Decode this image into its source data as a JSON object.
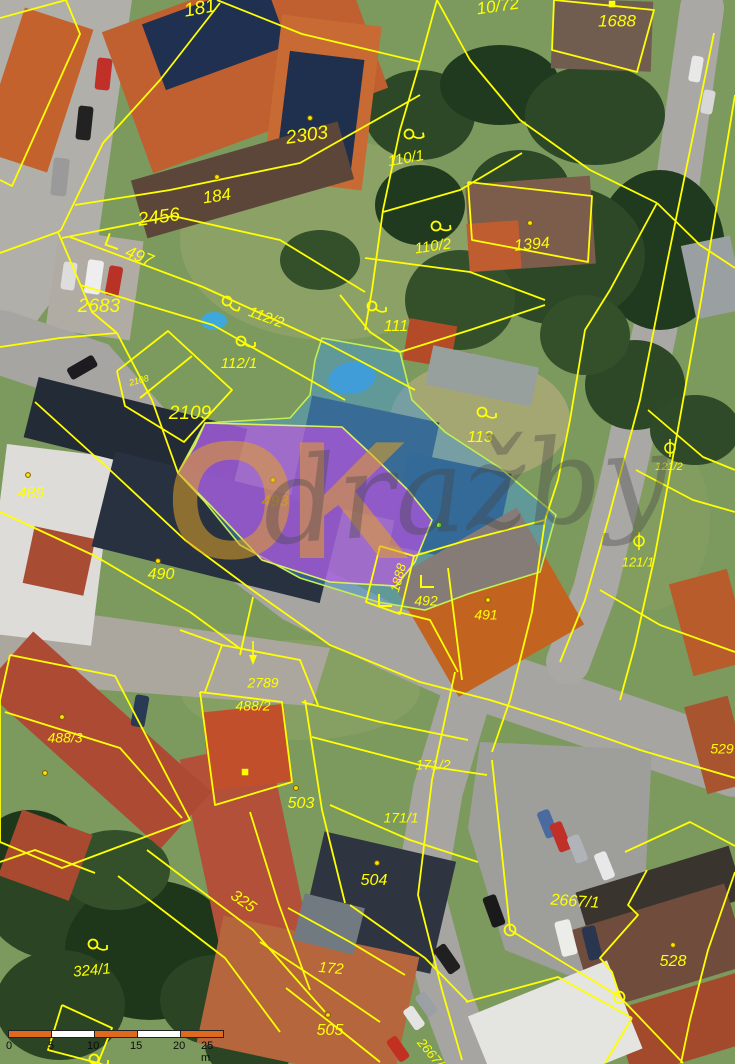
{
  "map": {
    "watermark": {
      "part1": "OK",
      "part2": "dražby"
    },
    "colors": {
      "boundary": "#ffff00",
      "label": "#ffff00",
      "label_muted": "#b8912a",
      "dot_fill": "#ffe400",
      "dot_green": "#86ff4d",
      "scalebar_orange": "#dd6a1e"
    },
    "highlights": {
      "blue": {
        "points": "322,338 400,352 412,400 445,432 500,468 556,515 540,572 468,594 425,610 378,602 300,578 240,545 205,502 178,473 205,423 290,418 310,395 315,360",
        "fill": "rgba(70,150,215,0.48)",
        "stroke": "#c3ef52"
      },
      "purple": {
        "points": "205,423 342,427 372,455 408,490 432,520 415,562 396,586 330,582 262,560 210,505 178,473 195,445",
        "fill": "rgba(198,80,232,0.62)",
        "stroke": "#d9f25a"
      }
    },
    "labels": [
      {
        "t": "181",
        "x": 200,
        "y": 9,
        "r": -10,
        "s": 19
      },
      {
        "t": "10/72",
        "x": 498,
        "y": 7,
        "r": -8,
        "s": 17
      },
      {
        "t": "1688",
        "x": 617,
        "y": 22,
        "r": 0,
        "s": 17
      },
      {
        "t": "2303",
        "x": 307,
        "y": 136,
        "r": -8,
        "s": 19
      },
      {
        "t": "184",
        "x": 217,
        "y": 197,
        "r": -8,
        "s": 17
      },
      {
        "t": "2456",
        "x": 159,
        "y": 218,
        "r": -8,
        "s": 19
      },
      {
        "t": "497",
        "x": 139,
        "y": 257,
        "r": 22,
        "s": 17
      },
      {
        "t": "2683",
        "x": 99,
        "y": 307,
        "r": 0,
        "s": 19
      },
      {
        "t": "110/1",
        "x": 406,
        "y": 159,
        "r": -10,
        "s": 15
      },
      {
        "t": "110/2",
        "x": 433,
        "y": 247,
        "r": -8,
        "s": 15
      },
      {
        "t": "1394",
        "x": 532,
        "y": 245,
        "r": -5,
        "s": 16
      },
      {
        "t": "112/2",
        "x": 266,
        "y": 318,
        "r": 20,
        "s": 15
      },
      {
        "t": "112/1",
        "x": 239,
        "y": 364,
        "r": 0,
        "s": 15
      },
      {
        "t": "111",
        "x": 396,
        "y": 327,
        "r": 0,
        "s": 16
      },
      {
        "t": "2108",
        "x": 139,
        "y": 381,
        "r": -15,
        "s": 9
      },
      {
        "t": "2109",
        "x": 190,
        "y": 414,
        "r": 0,
        "s": 19
      },
      {
        "t": "113",
        "x": 480,
        "y": 438,
        "r": 0,
        "s": 16
      },
      {
        "t": "121/2",
        "x": 669,
        "y": 467,
        "r": 0,
        "s": 11
      },
      {
        "t": "121/1",
        "x": 638,
        "y": 563,
        "r": 0,
        "s": 13
      },
      {
        "t": "489",
        "x": 31,
        "y": 494,
        "r": 0,
        "s": 16
      },
      {
        "t": "490",
        "x": 161,
        "y": 575,
        "r": 0,
        "s": 16
      },
      {
        "t": "493",
        "x": 275,
        "y": 502,
        "r": 0,
        "s": 16,
        "c": "#b8912a"
      },
      {
        "t": "1888",
        "x": 399,
        "y": 578,
        "r": -75,
        "s": 13
      },
      {
        "t": "492",
        "x": 426,
        "y": 602,
        "r": 0,
        "s": 14
      },
      {
        "t": "491",
        "x": 486,
        "y": 616,
        "r": 0,
        "s": 14
      },
      {
        "t": "529",
        "x": 722,
        "y": 750,
        "r": 0,
        "s": 14
      },
      {
        "t": "488/3",
        "x": 65,
        "y": 739,
        "r": 0,
        "s": 14
      },
      {
        "t": "2789",
        "x": 263,
        "y": 684,
        "r": 0,
        "s": 14
      },
      {
        "t": "488/2",
        "x": 253,
        "y": 707,
        "r": 0,
        "s": 14
      },
      {
        "t": "503",
        "x": 301,
        "y": 804,
        "r": 0,
        "s": 16
      },
      {
        "t": "171/2",
        "x": 433,
        "y": 766,
        "r": 0,
        "s": 14
      },
      {
        "t": "171/1",
        "x": 401,
        "y": 819,
        "r": 0,
        "s": 14
      },
      {
        "t": "504",
        "x": 374,
        "y": 881,
        "r": 0,
        "s": 16
      },
      {
        "t": "172",
        "x": 331,
        "y": 969,
        "r": 5,
        "s": 15
      },
      {
        "t": "505",
        "x": 330,
        "y": 1031,
        "r": 0,
        "s": 16
      },
      {
        "t": "325",
        "x": 243,
        "y": 902,
        "r": 35,
        "s": 16
      },
      {
        "t": "324/1",
        "x": 92,
        "y": 971,
        "r": -5,
        "s": 15
      },
      {
        "t": "2667/1",
        "x": 575,
        "y": 902,
        "r": 4,
        "s": 16
      },
      {
        "t": "528",
        "x": 673,
        "y": 962,
        "r": 0,
        "s": 16
      },
      {
        "t": "2667/2",
        "x": 432,
        "y": 1056,
        "r": 50,
        "s": 13
      }
    ],
    "symbols": [
      {
        "type": "loop",
        "x": 409,
        "y": 134,
        "r": -10
      },
      {
        "type": "loop",
        "x": 436,
        "y": 226,
        "r": -8
      },
      {
        "type": "loop",
        "x": 227,
        "y": 301,
        "r": 20
      },
      {
        "type": "loop",
        "x": 241,
        "y": 341,
        "r": 0
      },
      {
        "type": "loop",
        "x": 372,
        "y": 306,
        "r": 0
      },
      {
        "type": "loop",
        "x": 482,
        "y": 412,
        "r": 0
      },
      {
        "type": "loop",
        "x": 93,
        "y": 944,
        "r": 0
      },
      {
        "type": "loop",
        "x": 94,
        "y": 1059,
        "r": 0
      },
      {
        "type": "corner",
        "x": 113,
        "y": 242,
        "r": 20
      },
      {
        "type": "corner",
        "x": 385,
        "y": 601,
        "r": 0
      },
      {
        "type": "corner",
        "x": 427,
        "y": 582,
        "r": 0
      },
      {
        "type": "theta",
        "x": 670,
        "y": 448,
        "r": 0
      },
      {
        "type": "theta",
        "x": 639,
        "y": 541,
        "r": 0
      },
      {
        "type": "arrow",
        "x": 253,
        "y": 655,
        "r": 0
      },
      {
        "type": "circle",
        "x": 510,
        "y": 930,
        "r": 0
      },
      {
        "type": "circle",
        "x": 619,
        "y": 997,
        "r": 0
      },
      {
        "type": "square",
        "x": 612,
        "y": 4,
        "r": 0
      },
      {
        "type": "square",
        "x": 245,
        "y": 772,
        "r": 0
      },
      {
        "type": "dot",
        "x": 310,
        "y": 118
      },
      {
        "type": "dot",
        "x": 217,
        "y": 177
      },
      {
        "type": "dot",
        "x": 530,
        "y": 223
      },
      {
        "type": "dot",
        "x": 28,
        "y": 475
      },
      {
        "type": "dot",
        "x": 158,
        "y": 561
      },
      {
        "type": "dot",
        "x": 273,
        "y": 480
      },
      {
        "type": "dot",
        "x": 488,
        "y": 600
      },
      {
        "type": "dot",
        "x": 62,
        "y": 717
      },
      {
        "type": "dot",
        "x": 45,
        "y": 773
      },
      {
        "type": "dot",
        "x": 296,
        "y": 788
      },
      {
        "type": "dot",
        "x": 377,
        "y": 863
      },
      {
        "type": "dot",
        "x": 328,
        "y": 1015
      },
      {
        "type": "dot",
        "x": 673,
        "y": 945
      },
      {
        "type": "dot-green",
        "x": 439,
        "y": 525
      }
    ],
    "boundaries": [
      {
        "p": "0,18 66,0 80,34 12,186 0,180"
      },
      {
        "p": "220,3 160,80 103,143 61,230 58,232"
      },
      {
        "p": "217,0 302,34 420,62"
      },
      {
        "p": "420,62 437,0"
      },
      {
        "p": "420,62 400,130 383,210 372,290 365,330"
      },
      {
        "p": "437,0 470,60 520,120 590,170 657,203"
      },
      {
        "p": "657,203 610,290 585,330 570,420 558,480 545,520"
      },
      {
        "p": "657,203 700,245 735,268"
      },
      {
        "p": "554,0 654,10 637,72 552,50 554,0"
      },
      {
        "p": "75,205 170,190 300,163 420,95"
      },
      {
        "p": "62,238 173,216 280,240 365,292"
      },
      {
        "p": "70,237 203,287 330,345 415,390"
      },
      {
        "p": "80,285 213,325 345,400"
      },
      {
        "p": "383,212 460,190 522,153"
      },
      {
        "p": "365,258 470,272 545,300"
      },
      {
        "p": "340,295 370,332 400,352"
      },
      {
        "p": "400,352 470,330 545,305"
      },
      {
        "p": "117,371 168,331 232,390 184,442 125,406 117,371"
      },
      {
        "p": "140,398 192,356"
      },
      {
        "p": "0,253 58,232"
      },
      {
        "p": "58,232 92,312 117,333"
      },
      {
        "p": "0,347 60,338 117,333"
      },
      {
        "p": "117,333 152,400 178,473"
      },
      {
        "p": "35,402 110,470 185,540 255,592 330,645 420,682 490,700 560,722 640,750 735,778"
      },
      {
        "p": "0,512 95,556 190,612 242,650"
      },
      {
        "p": "253,597 240,655"
      },
      {
        "p": "468,182 592,196 588,262 472,240 468,182"
      },
      {
        "p": "414,556 468,540 545,520"
      },
      {
        "p": "448,568 462,680"
      },
      {
        "p": "545,520 532,612 510,700 492,752"
      },
      {
        "p": "380,546 414,556 400,614 366,602 380,546"
      },
      {
        "p": "398,612 430,620 458,672"
      },
      {
        "p": "714,33 667,263 640,400 608,520 585,600 560,662"
      },
      {
        "p": "735,95 702,295 676,440 655,555 635,645 620,700"
      },
      {
        "p": "648,410 703,457 735,470"
      },
      {
        "p": "636,470 693,500 735,512"
      },
      {
        "p": "600,590 660,625 735,652"
      },
      {
        "p": "625,852 690,822 735,846"
      },
      {
        "p": "735,872 708,950 690,1020 681,1063"
      },
      {
        "p": "647,870 628,905 638,915 600,958 612,972 620,997"
      },
      {
        "p": "492,760 510,930"
      },
      {
        "p": "510,930 620,997"
      },
      {
        "p": "620,997 683,1063"
      },
      {
        "p": "455,672 432,780 418,895 442,990 462,1060"
      },
      {
        "p": "302,702 380,722 468,740"
      },
      {
        "p": "312,737 420,765 487,775"
      },
      {
        "p": "330,805 410,840 478,862"
      },
      {
        "p": "305,700 322,810 345,903"
      },
      {
        "p": "250,812 278,902 310,990"
      },
      {
        "p": "350,905 425,958 468,1002"
      },
      {
        "p": "288,908 350,942 405,975"
      },
      {
        "p": "260,942 330,988 380,1022"
      },
      {
        "p": "286,988 340,1030 380,1062"
      },
      {
        "p": "147,850 253,930 325,1012"
      },
      {
        "p": "118,876 225,958 280,1032"
      },
      {
        "p": "62,1005 112,1028 98,1063 48,1050 62,1005"
      },
      {
        "p": "0,862 35,850 95,873"
      },
      {
        "p": "10,655 115,676 190,820 62,868 0,842 0,700 10,655"
      },
      {
        "p": "5,712 120,748 182,818"
      },
      {
        "p": "200,692 282,702 292,782 215,805 200,692"
      },
      {
        "p": "222,645 205,692"
      },
      {
        "p": "180,630 222,645 300,660 318,705"
      },
      {
        "p": "466,1002 558,977 632,1018"
      },
      {
        "p": "632,1018 605,1063"
      }
    ],
    "scalebar": {
      "ticks": [
        "0",
        "5",
        "10",
        "15",
        "20",
        "25 m"
      ],
      "tick_lefts": [
        -2,
        40,
        79,
        122,
        165,
        193
      ],
      "segment_colors": [
        "#dd6a1e",
        "#ffffff",
        "#dd6a1e",
        "#ffffff",
        "#dd6a1e"
      ]
    }
  }
}
